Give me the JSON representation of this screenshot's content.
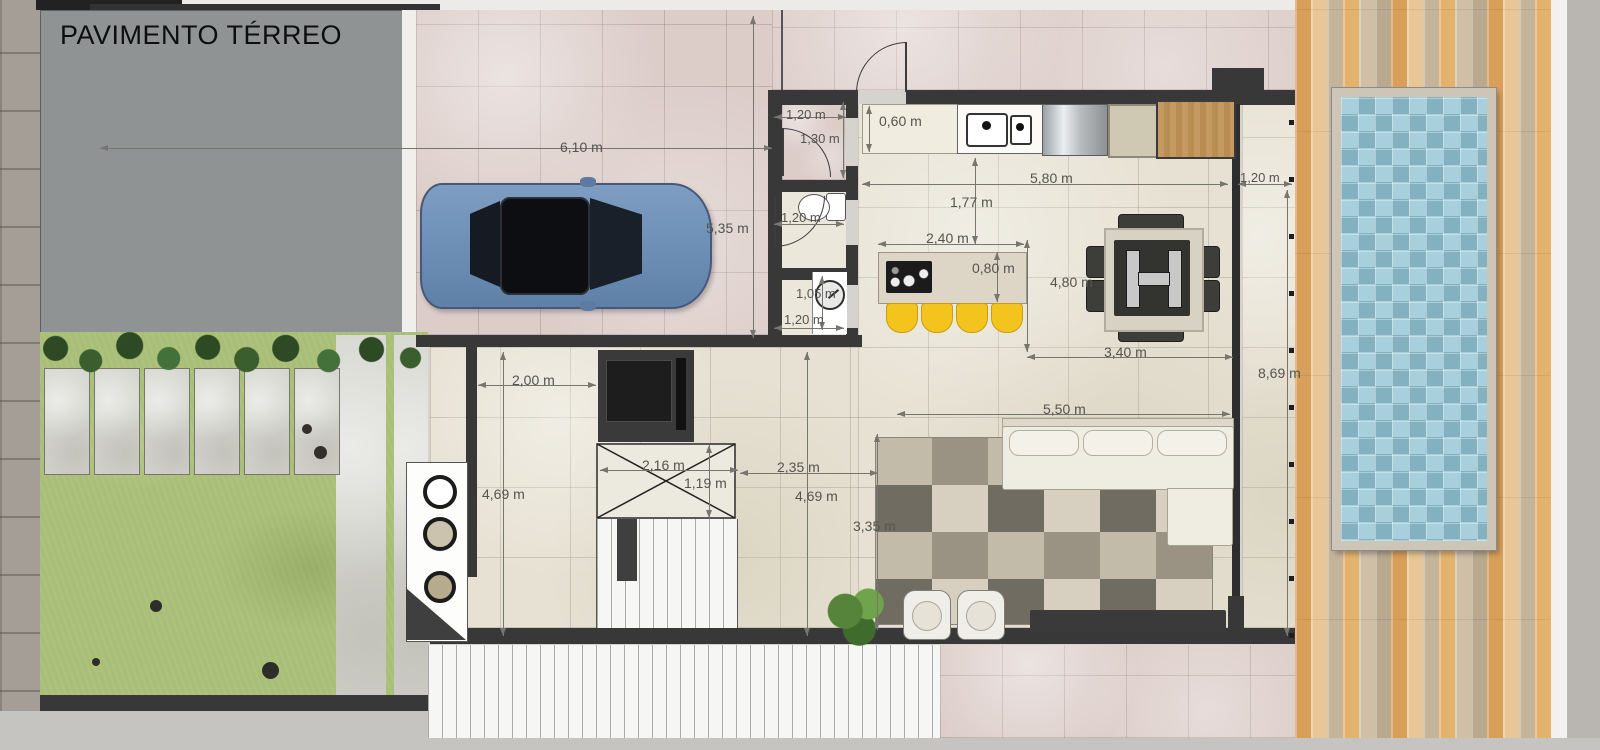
{
  "title": "PAVIMENTO TÉRREO",
  "dimensions": [
    {
      "id": "garage-width",
      "text": "6,10 m"
    },
    {
      "id": "garage-depth",
      "text": "5,35 m"
    },
    {
      "id": "entry-width",
      "text": "1,20 m"
    },
    {
      "id": "entry-depth",
      "text": "1,30 m"
    },
    {
      "id": "counter-depth",
      "text": "0,60 m"
    },
    {
      "id": "kitchen-width",
      "text": "5,80 m"
    },
    {
      "id": "side-corridor-width",
      "text": "1,20 m"
    },
    {
      "id": "kitchen-clearance",
      "text": "1,77 m"
    },
    {
      "id": "bathroom-width",
      "text": "1,20 m"
    },
    {
      "id": "island-length",
      "text": "2,40 m"
    },
    {
      "id": "island-depth",
      "text": "0,80 m"
    },
    {
      "id": "dining-depth",
      "text": "4,80 m"
    },
    {
      "id": "laundry-depth",
      "text": "1,05 m"
    },
    {
      "id": "laundry-width",
      "text": "1,20 m"
    },
    {
      "id": "dining-width",
      "text": "3,40 m"
    },
    {
      "id": "side-corridor-length",
      "text": "8,69 m"
    },
    {
      "id": "hall-width",
      "text": "2,00 m"
    },
    {
      "id": "hall-depth",
      "text": "4,69 m"
    },
    {
      "id": "stair-void-width",
      "text": "2,16 m"
    },
    {
      "id": "stair-void-depth",
      "text": "1,19 m"
    },
    {
      "id": "living-gap",
      "text": "2,35 m"
    },
    {
      "id": "living-depth",
      "text": "4,69 m"
    },
    {
      "id": "living-width",
      "text": "5,50 m"
    },
    {
      "id": "rug-depth",
      "text": "3,35 m"
    }
  ],
  "colors": {
    "wall": "#383838",
    "interior_tile": "#e6e1d2",
    "garage_tile": "#dccdc9",
    "pool_water": "#a3ccd9",
    "deck_wood": "#dcae72",
    "grass": "#a9bf77",
    "stool_accent": "#f2c41d",
    "car_body": "#7b9cc4"
  }
}
